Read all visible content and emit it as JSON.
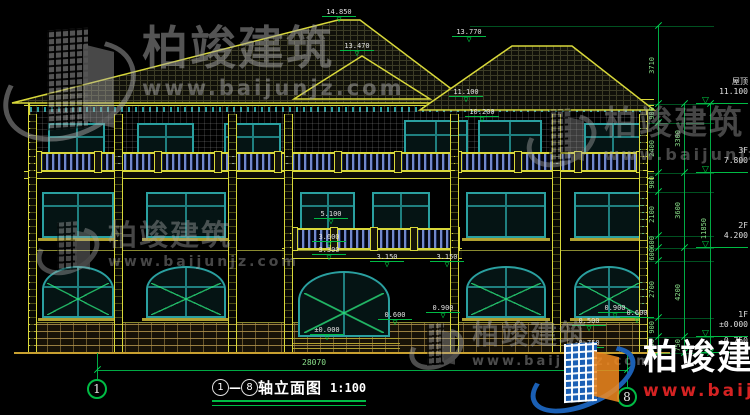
{
  "watermark": {
    "company": "柏竣建筑",
    "url": "www.baijunjz.com"
  },
  "title_block": {
    "axis_from": "1",
    "dash": "—",
    "axis_to": "8",
    "title": "轴立面图",
    "scale": "1:100"
  },
  "axis_bubbles": [
    {
      "label": "1",
      "cx": 97,
      "cy": 389
    },
    {
      "label": "8",
      "cx": 627,
      "cy": 397
    }
  ],
  "bottom_dim": {
    "label": "28070",
    "x1": 97,
    "x2": 627,
    "y": 370,
    "label_x": 302,
    "label_y": 358
  },
  "elevation_markers": [
    {
      "v": "14.850",
      "x": 322,
      "y": 8
    },
    {
      "v": "13.770",
      "x": 452,
      "y": 28
    },
    {
      "v": "13.470",
      "x": 340,
      "y": 42
    },
    {
      "v": "11.100",
      "x": 449,
      "y": 88
    },
    {
      "v": "10.200",
      "x": 465,
      "y": 108
    },
    {
      "v": "5.100",
      "x": 314,
      "y": 210
    },
    {
      "v": "3.600",
      "x": 312,
      "y": 233
    },
    {
      "v": "3.300",
      "x": 312,
      "y": 246
    },
    {
      "v": "3.150",
      "x": 370,
      "y": 253
    },
    {
      "v": "3.150",
      "x": 430,
      "y": 253
    },
    {
      "v": "0.900",
      "x": 426,
      "y": 304
    },
    {
      "v": "0.900",
      "x": 598,
      "y": 304
    },
    {
      "v": "0.600",
      "x": 378,
      "y": 311
    },
    {
      "v": "0.600",
      "x": 620,
      "y": 309
    },
    {
      "v": "0.500",
      "x": 572,
      "y": 317
    },
    {
      "v": "±0.000",
      "x": 310,
      "y": 326
    },
    {
      "v": "-0.750",
      "x": 570,
      "y": 339
    }
  ],
  "right_levels": [
    {
      "name": "屋顶",
      "value": "11.100",
      "y": 104
    },
    {
      "name": "3F",
      "value": "7.800",
      "y": 173
    },
    {
      "name": "2F",
      "value": "4.200",
      "y": 248
    },
    {
      "name": "1F",
      "value": "±0.000",
      "y": 337
    },
    {
      "name": "",
      "value": "-0.750",
      "y": 353
    }
  ],
  "dim_chains": [
    {
      "x": 658,
      "segments": [
        {
          "y1": 26,
          "y2": 104,
          "label": "3710"
        },
        {
          "y1": 104,
          "y2": 123,
          "label": "900"
        },
        {
          "y1": 123,
          "y2": 173,
          "label": "2400"
        },
        {
          "y1": 173,
          "y2": 192,
          "label": "900"
        },
        {
          "y1": 192,
          "y2": 236,
          "label": "2100"
        },
        {
          "y1": 236,
          "y2": 248,
          "label": "600"
        },
        {
          "y1": 248,
          "y2": 261,
          "label": "600"
        },
        {
          "y1": 261,
          "y2": 318,
          "label": "2700"
        },
        {
          "y1": 318,
          "y2": 337,
          "label": "900"
        },
        {
          "y1": 337,
          "y2": 353,
          "label": "750"
        }
      ]
    },
    {
      "x": 684,
      "segments": [
        {
          "y1": 104,
          "y2": 173,
          "label": "3300"
        },
        {
          "y1": 173,
          "y2": 248,
          "label": "3600"
        },
        {
          "y1": 248,
          "y2": 337,
          "label": "4200"
        },
        {
          "y1": 337,
          "y2": 353,
          "label": "750"
        }
      ]
    },
    {
      "x": 710,
      "segments": [
        {
          "y1": 104,
          "y2": 353,
          "label": "11850"
        }
      ]
    }
  ],
  "colors": {
    "cad_line": "#d8d83a",
    "dim_green": "#00cc44",
    "window_frame": "#2aa0a0",
    "baluster_blue": "#7288cc",
    "wm_red": "#d42222",
    "wm_blue": "#1a5fb4",
    "wm_orange": "#f28a1e"
  }
}
